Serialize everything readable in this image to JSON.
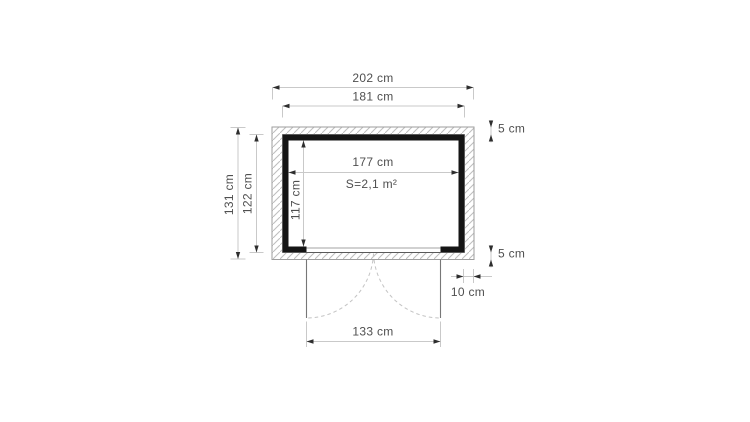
{
  "drawing": {
    "area_label": "S=2,1 m²",
    "dimensions": {
      "roof_width": "202 cm",
      "wall_outer_width": "181 cm",
      "roof_depth": "131 cm",
      "wall_outer_depth": "122 cm",
      "interior_width": "177 cm",
      "interior_depth": "117 cm",
      "roof_overhang_front": "5 cm",
      "roof_overhang_rear": "5 cm",
      "roof_overhang_side": "10 cm",
      "door_opening_width": "133 cm"
    },
    "colors": {
      "wall": "#151515",
      "dim_line": "#c9c9c9",
      "arrow": "#2e2e2e",
      "text": "#4f4f4f",
      "hatch_line": "#bdbdbd",
      "outline": "#9e9e9e",
      "background": "#ffffff"
    }
  }
}
